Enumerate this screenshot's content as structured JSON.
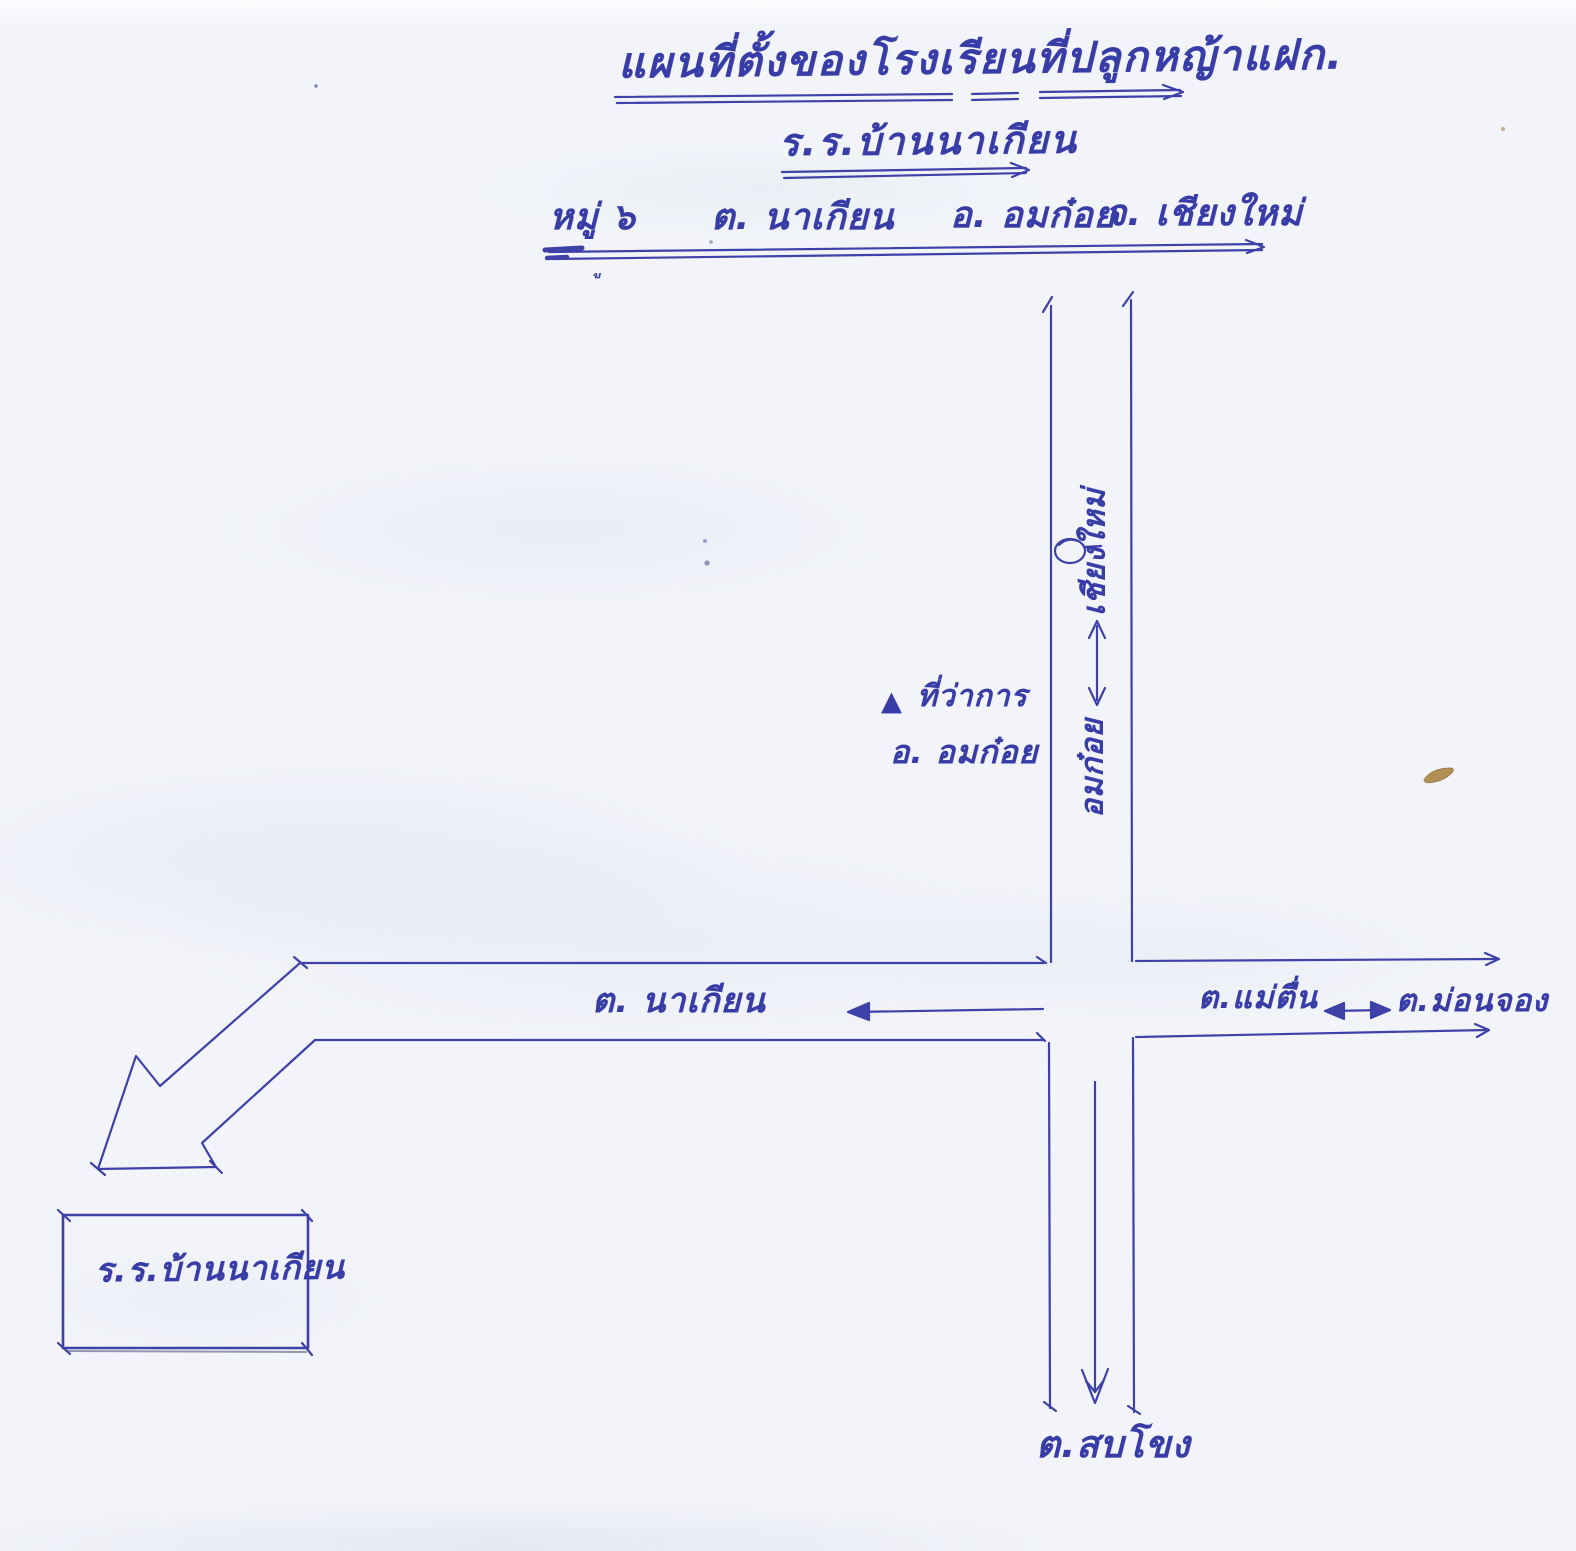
{
  "document": {
    "title": "แผนที่ตั้งของโรงเรียนที่ปลูกหญ้าแฝก.",
    "school_name": "ร.ร.บ้านนาเกียน",
    "address": {
      "village": "หมู่ ๖",
      "subdistrict": "ต. นาเกียน",
      "district": "อ. อมก๋อย",
      "province": "จ. เชียงใหม่"
    },
    "stray_vowel_mark": "ู"
  },
  "map": {
    "labels": {
      "north_destination": "เชียงใหม่",
      "north_origin": "อมก๋อย",
      "district_office_line1": "ที่ว่าการ",
      "district_office_line2": "อ. อมก๋อย",
      "west_destination": "ต. นาเกียน",
      "east_near": "ต.แม่ตื่น",
      "east_far": "ต.ม่อนจอง",
      "south_destination": "ต.สบโขง",
      "school_box": "ร.ร.บ้านนาเกียน"
    },
    "icons": {
      "district_office_marker": "▲",
      "road_point_marker": "○"
    },
    "colors": {
      "ink": "#383ca6",
      "paper": "#f2f4f9",
      "stain": "#ab8544"
    }
  }
}
